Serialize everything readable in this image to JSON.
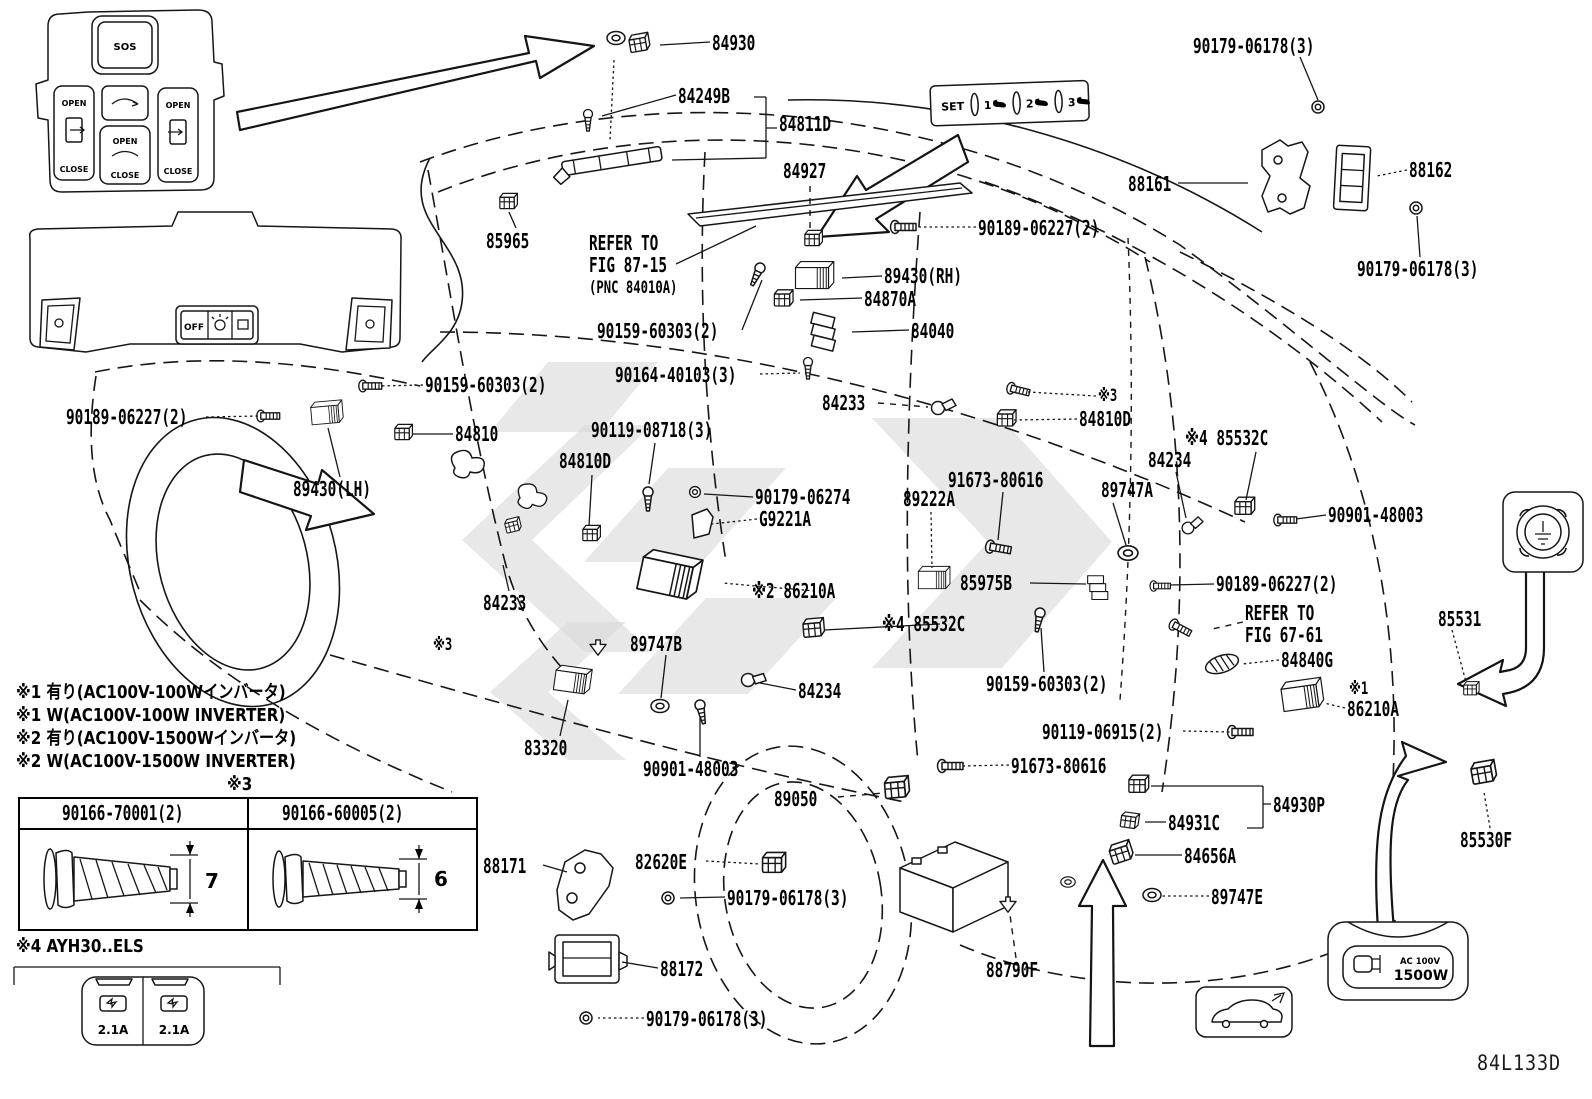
{
  "diagram": {
    "code": "84L133D",
    "accent_black": "#161616",
    "watermark_gray": "#dadada"
  },
  "labels": [
    {
      "t": "84930",
      "x": 712,
      "y": 33
    },
    {
      "t": "84249B",
      "x": 678,
      "y": 86
    },
    {
      "t": "84811D",
      "x": 779,
      "y": 114
    },
    {
      "t": "84927",
      "x": 783,
      "y": 161
    },
    {
      "t": "90179-06178(3)",
      "x": 1193,
      "y": 36
    },
    {
      "t": "88161",
      "x": 1128,
      "y": 174
    },
    {
      "t": "88162",
      "x": 1409,
      "y": 160
    },
    {
      "t": "90179-06178(3)",
      "x": 1357,
      "y": 259
    },
    {
      "t": "85965",
      "x": 486,
      "y": 231
    },
    {
      "t": "REFER TO",
      "x": 589,
      "y": 233
    },
    {
      "t": "FIG 87-15",
      "x": 589,
      "y": 255
    },
    {
      "t": "(PNC 84010A)",
      "x": 589,
      "y": 280,
      "fs": 17
    },
    {
      "t": "90189-06227(2)",
      "x": 978,
      "y": 218
    },
    {
      "t": "89430(RH)",
      "x": 884,
      "y": 266
    },
    {
      "t": "84870A",
      "x": 864,
      "y": 289
    },
    {
      "t": "84040",
      "x": 911,
      "y": 321
    },
    {
      "t": "90159-60303(2)",
      "x": 597,
      "y": 321
    },
    {
      "t": "90164-40103(3)",
      "x": 615,
      "y": 365
    },
    {
      "t": "84233",
      "x": 822,
      "y": 393
    },
    {
      "t": "※3",
      "x": 1098,
      "y": 388,
      "fs": 17
    },
    {
      "t": "84810D",
      "x": 1079,
      "y": 409
    },
    {
      "t": "90159-60303(2)",
      "x": 425,
      "y": 375
    },
    {
      "t": "90189-06227(2)",
      "x": 66,
      "y": 407
    },
    {
      "t": "84810",
      "x": 455,
      "y": 424
    },
    {
      "t": "84810D",
      "x": 559,
      "y": 451
    },
    {
      "t": "90119-08718(3)",
      "x": 591,
      "y": 420
    },
    {
      "t": "89430(LH)",
      "x": 293,
      "y": 479
    },
    {
      "t": "90179-06274",
      "x": 755,
      "y": 487
    },
    {
      "t": "G9221A",
      "x": 759,
      "y": 509
    },
    {
      "t": "91673-80616",
      "x": 948,
      "y": 470
    },
    {
      "t": "89222A",
      "x": 903,
      "y": 489
    },
    {
      "t": "89747A",
      "x": 1101,
      "y": 480
    },
    {
      "t": "84234",
      "x": 1148,
      "y": 450
    },
    {
      "t": "※4 85532C",
      "x": 1185,
      "y": 428
    },
    {
      "t": "90901-48003",
      "x": 1328,
      "y": 505
    },
    {
      "t": "85975B",
      "x": 960,
      "y": 573
    },
    {
      "t": "90189-06227(2)",
      "x": 1216,
      "y": 574
    },
    {
      "t": "※4 85532C",
      "x": 882,
      "y": 614
    },
    {
      "t": "REFER TO",
      "x": 1245,
      "y": 603
    },
    {
      "t": "FIG 67-61",
      "x": 1245,
      "y": 625
    },
    {
      "t": "84840G",
      "x": 1281,
      "y": 650
    },
    {
      "t": "※1",
      "x": 1349,
      "y": 681,
      "fs": 17
    },
    {
      "t": "86210A",
      "x": 1347,
      "y": 699
    },
    {
      "t": "※2 86210A",
      "x": 752,
      "y": 581
    },
    {
      "t": "89747B",
      "x": 630,
      "y": 634
    },
    {
      "t": "84233",
      "x": 483,
      "y": 593
    },
    {
      "t": "※3",
      "x": 433,
      "y": 637,
      "fs": 17
    },
    {
      "t": "84234",
      "x": 798,
      "y": 681
    },
    {
      "t": "83320",
      "x": 524,
      "y": 738
    },
    {
      "t": "90901-48003",
      "x": 643,
      "y": 759
    },
    {
      "t": "90159-60303(2)",
      "x": 986,
      "y": 674
    },
    {
      "t": "90119-06915(2)",
      "x": 1042,
      "y": 722
    },
    {
      "t": "91673-80616",
      "x": 1011,
      "y": 756
    },
    {
      "t": "89050",
      "x": 774,
      "y": 789
    },
    {
      "t": "88171",
      "x": 483,
      "y": 856
    },
    {
      "t": "82620E",
      "x": 635,
      "y": 852
    },
    {
      "t": "90179-06178(3)",
      "x": 727,
      "y": 888
    },
    {
      "t": "88172",
      "x": 660,
      "y": 959
    },
    {
      "t": "90179-06178(3)",
      "x": 646,
      "y": 1009
    },
    {
      "t": "88790F",
      "x": 986,
      "y": 960
    },
    {
      "t": "84930P",
      "x": 1273,
      "y": 795
    },
    {
      "t": "84931C",
      "x": 1168,
      "y": 813
    },
    {
      "t": "84656A",
      "x": 1184,
      "y": 846
    },
    {
      "t": "89747E",
      "x": 1211,
      "y": 887
    },
    {
      "t": "85531",
      "x": 1438,
      "y": 609
    },
    {
      "t": "85530F",
      "x": 1460,
      "y": 830
    },
    {
      "t": "※1 有り(AC100V-100Wインバータ)",
      "x": 16,
      "y": 684,
      "c": "note"
    },
    {
      "t": "※1 W(AC100V-100W INVERTER)",
      "x": 16,
      "y": 707,
      "c": "note"
    },
    {
      "t": "※2 有り(AC100V-1500Wインバータ)",
      "x": 16,
      "y": 730,
      "c": "note"
    },
    {
      "t": "※2 W(AC100V-1500W INVERTER)",
      "x": 16,
      "y": 753,
      "c": "note"
    },
    {
      "t": "※3",
      "x": 227,
      "y": 776,
      "c": "note"
    },
    {
      "t": "※4 AYH30..ELS",
      "x": 16,
      "y": 938,
      "c": "note"
    },
    {
      "t": "84L133D",
      "x": 1477,
      "y": 1053,
      "c": "code"
    }
  ],
  "notes_refer": {
    "fig1_line1": "REFER TO",
    "fig1_line2": "FIG 87-15",
    "fig1_line3": "(PNC 84010A)",
    "fig2_line1": "REFER TO",
    "fig2_line2": "FIG 67-61"
  },
  "screw_table": {
    "col1": "90166-70001(2)",
    "col2": "90166-60005(2)",
    "dim1": "7",
    "dim2": "6"
  },
  "panels": {
    "door_switch": {
      "sos": "SOS",
      "open": "OPEN",
      "close": "CLOSE"
    },
    "overhead": {
      "off": "OFF"
    },
    "seat_memory": {
      "set": "SET",
      "one": "1",
      "two": "2",
      "three": "3"
    },
    "usb": {
      "amp_left": "2.1A",
      "amp_right": "2.1A"
    },
    "ac_outlet": {
      "volts": "AC 100V",
      "watts": "1500W"
    }
  }
}
